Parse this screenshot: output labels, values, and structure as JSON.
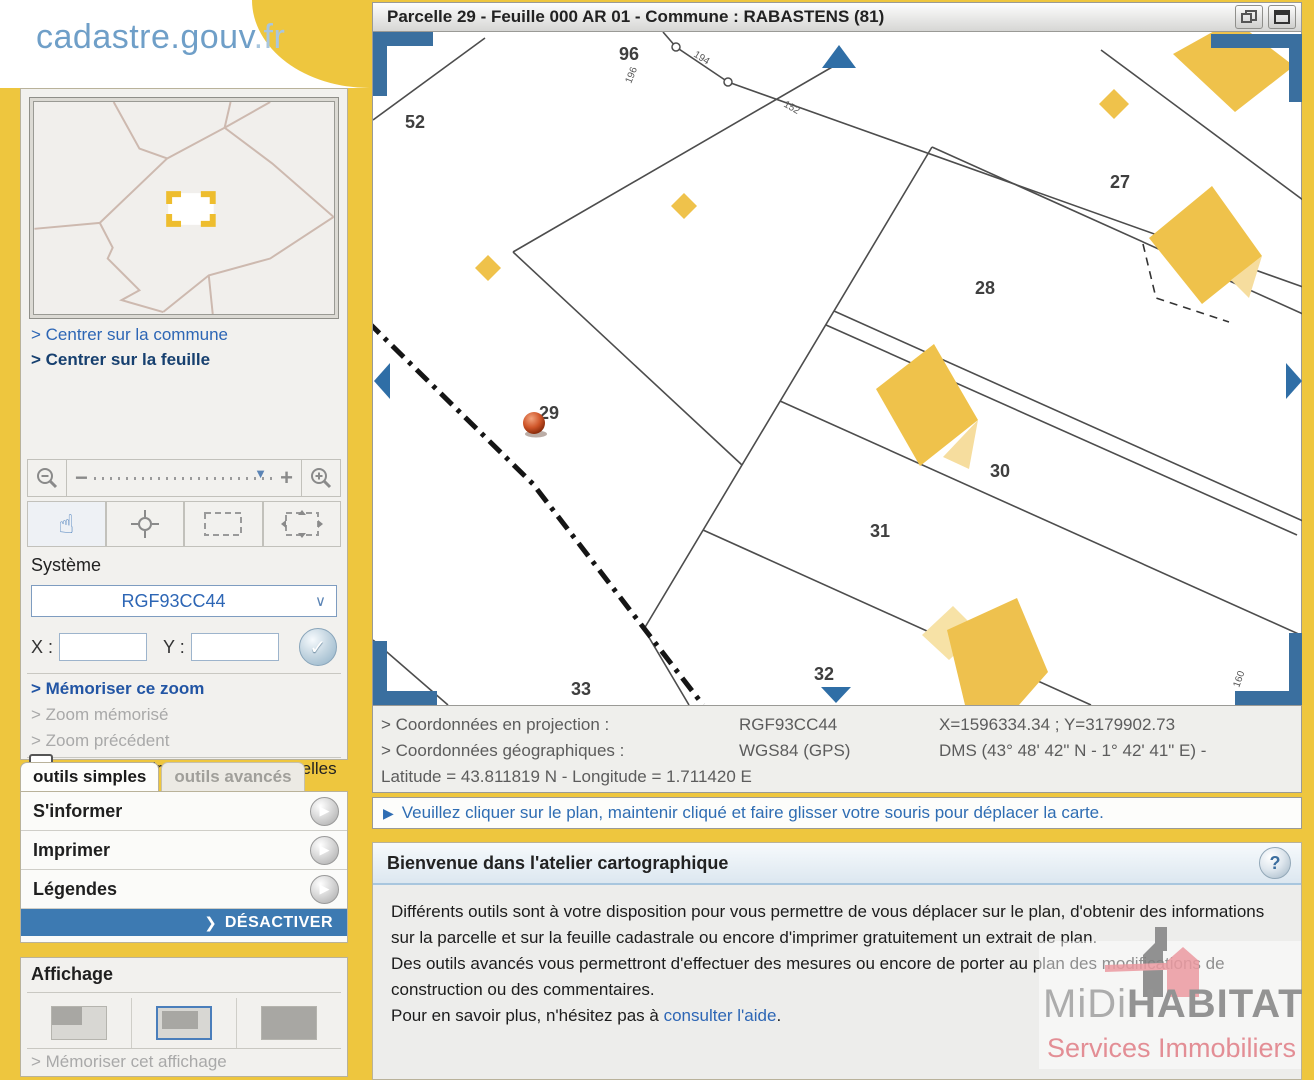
{
  "brand": {
    "name": "cadastre",
    "dot_gouv": ".gouv",
    "fr": ".fr"
  },
  "sidebar": {
    "links": {
      "center_commune": "> Centrer sur la commune",
      "center_feuille": "> Centrer sur la feuille"
    },
    "zoom": {
      "minus": "−",
      "plus": "+",
      "marker": "▼"
    },
    "system": {
      "label": "Système",
      "value": "RGF93CC44",
      "chevron": "⌄",
      "x_label": "X :",
      "y_label": "Y :",
      "ok": "✓"
    },
    "memory_links": {
      "memorize": "> Mémoriser ce zoom",
      "memorized": "> Zoom mémorisé",
      "previous": "> Zoom précédent"
    },
    "flag_checkbox_label": "Afficher un drapeau sur les parcelles en instance d'une mise à jour graphique",
    "tabs": {
      "simple": "outils simples",
      "advanced": "outils avancés"
    },
    "tools": [
      {
        "label": "S'informer"
      },
      {
        "label": "Imprimer"
      },
      {
        "label": "Légendes"
      }
    ],
    "tool_arrow": "▶",
    "deactivate": {
      "arrow": "❯",
      "label": "DÉSACTIVER"
    },
    "display": {
      "title": "Affichage",
      "memorize_link": "> Mémoriser cet affichage"
    }
  },
  "map": {
    "title": "Parcelle 29 - Feuille 000 AR 01 - Commune : RABASTENS (81)",
    "parcels": [
      {
        "label": "52"
      },
      {
        "label": "96"
      },
      {
        "label": "27"
      },
      {
        "label": "28"
      },
      {
        "label": "29"
      },
      {
        "label": "30"
      },
      {
        "label": "31"
      },
      {
        "label": "32"
      },
      {
        "label": "33"
      }
    ],
    "road_numbers": [
      {
        "label": "196"
      },
      {
        "label": "194"
      },
      {
        "label": "152"
      },
      {
        "label": "160"
      }
    ],
    "colors": {
      "building": "#efc24b",
      "building_light": "#f6dd9e",
      "nav_blue": "#2f6ea6",
      "bracket_blue": "#3a6f9f",
      "line": "#4d4d4d",
      "marker_red": "#c2491f"
    }
  },
  "coords": {
    "row1": {
      "label": "> Coordonnées en projection :",
      "system": "RGF93CC44",
      "values": "X=1596334.34 ; Y=3179902.73"
    },
    "row2": {
      "label": "> Coordonnées géographiques :",
      "system": "WGS84 (GPS)",
      "values": "DMS (43° 48' 42\" N - 1° 42' 41\" E) -"
    },
    "row3": "Latitude = 43.811819 N - Longitude = 1.711420 E"
  },
  "instruction": "Veuillez cliquer sur le plan, maintenir cliqué et faire glisser votre souris pour déplacer la carte.",
  "welcome": {
    "title": "Bienvenue dans l'atelier cartographique",
    "help": "?",
    "p1": "Différents outils sont à votre disposition pour vous permettre de vous déplacer sur le plan, d'obtenir des informations sur la parcelle et sur la feuille cadastrale ou encore d'imprimer gratuitement un extrait de plan.",
    "p2": "Des outils avancés vous permettront d'effectuer des mesures ou encore de porter au plan des modifications de construction ou des commentaires.",
    "p3_prefix": "Pour en savoir plus, n'hésitez pas à ",
    "p3_link": "consulter l'aide",
    "p3_suffix": "."
  },
  "watermark": {
    "midi": "MiDi",
    "habitat": "HABITAT",
    "subtitle": "Services Immobiliers"
  }
}
